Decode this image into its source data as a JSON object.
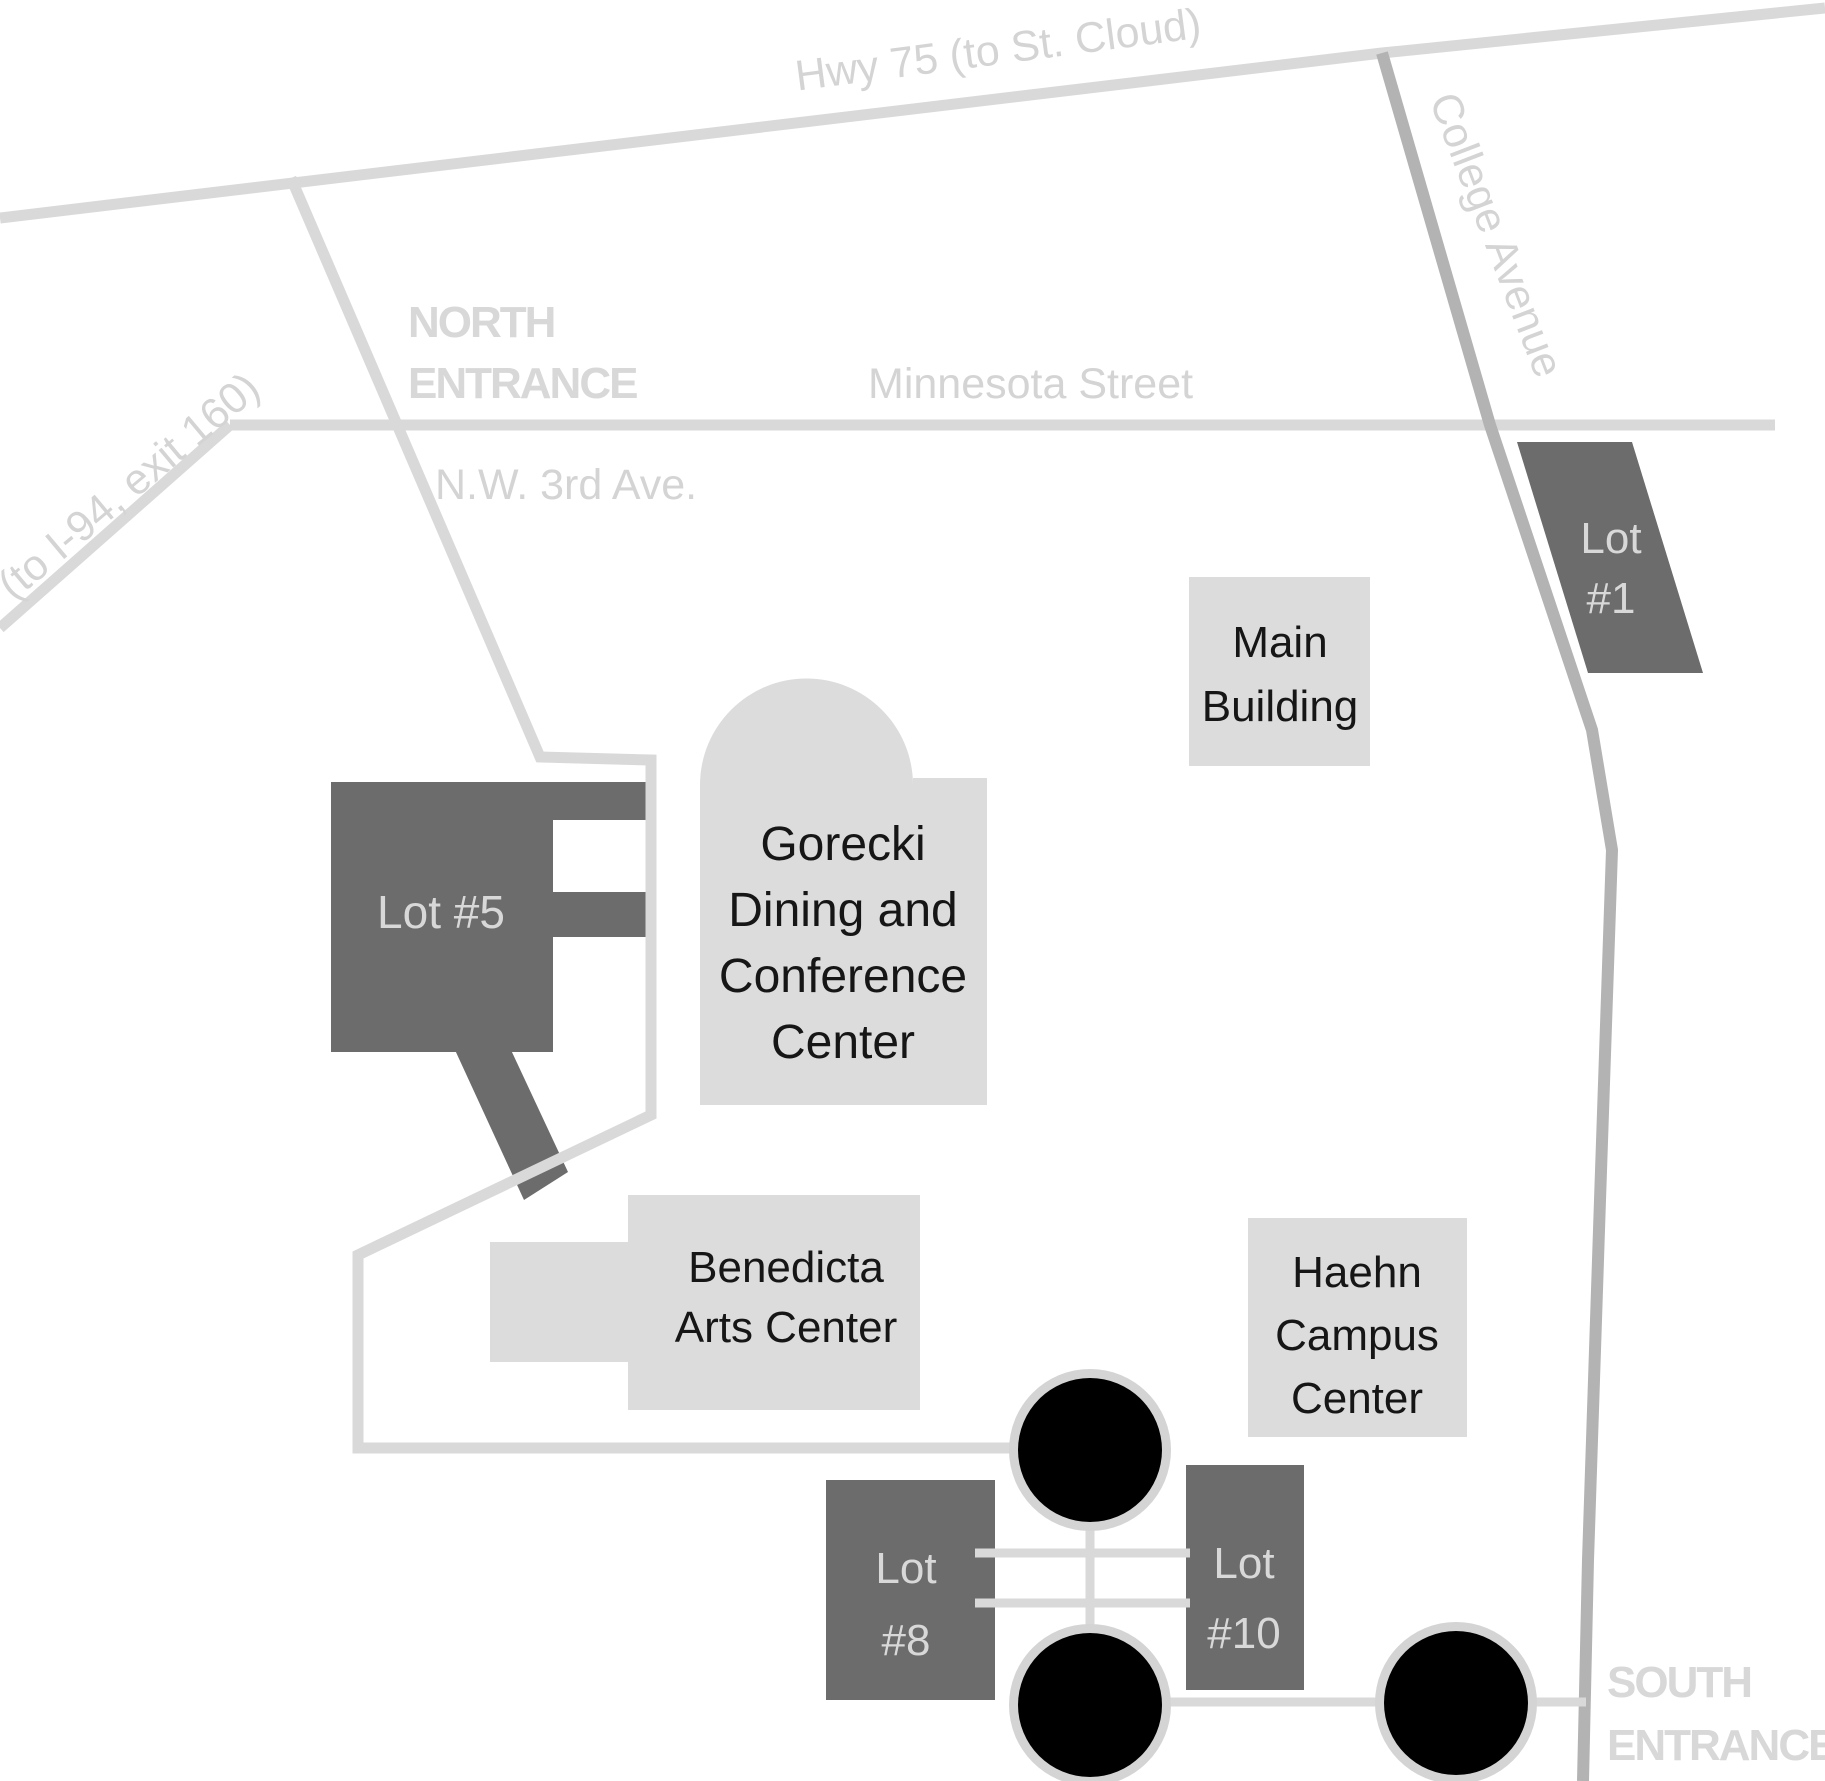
{
  "map": {
    "description": "Campus map with roads, entrances, buildings, parking lots and roundabouts"
  },
  "roads": {
    "hwy75": {
      "label": "Hwy 75 (to St. Cloud)"
    },
    "minnesota": {
      "label": "Minnesota Street"
    },
    "nw_3rd": {
      "label": "N.W. 3rd Ave."
    },
    "college": {
      "label": "College Avenue"
    },
    "i94": {
      "label": "(to I-94, exit 160)"
    }
  },
  "entrances": {
    "north": {
      "lines": [
        "NORTH",
        "ENTRANCE"
      ]
    },
    "south": {
      "lines": [
        "SOUTH",
        "ENTRANCE"
      ]
    }
  },
  "buildings": {
    "main": {
      "lines": [
        "Main",
        "Building"
      ]
    },
    "gorecki": {
      "lines": [
        "Gorecki",
        "Dining and",
        "Conference",
        "Center"
      ]
    },
    "benedicta": {
      "lines": [
        "Benedicta",
        "Arts Center"
      ]
    },
    "haehn": {
      "lines": [
        "Haehn",
        "Campus",
        "Center"
      ]
    }
  },
  "lots": {
    "lot1": {
      "lines": [
        "Lot",
        "#1"
      ]
    },
    "lot5": {
      "lines": [
        "Lot #5"
      ]
    },
    "lot8": {
      "lines": [
        "Lot",
        "#8"
      ]
    },
    "lot10": {
      "lines": [
        "Lot",
        "#10"
      ]
    }
  },
  "colors": {
    "background": "#ffffff",
    "road": "#d9d9d9",
    "college_avenue_road": "#b3b3b3",
    "road_label": "#d4d4d4",
    "entrance_label": "#d8d8d8",
    "building_fill": "#dcdcdc",
    "building_label": "#161616",
    "lot_fill": "#6c6c6c",
    "lot_label": "#d8d8d8",
    "roundabout_fill": "#000000",
    "roundabout_ring": "#d4d4d4"
  }
}
